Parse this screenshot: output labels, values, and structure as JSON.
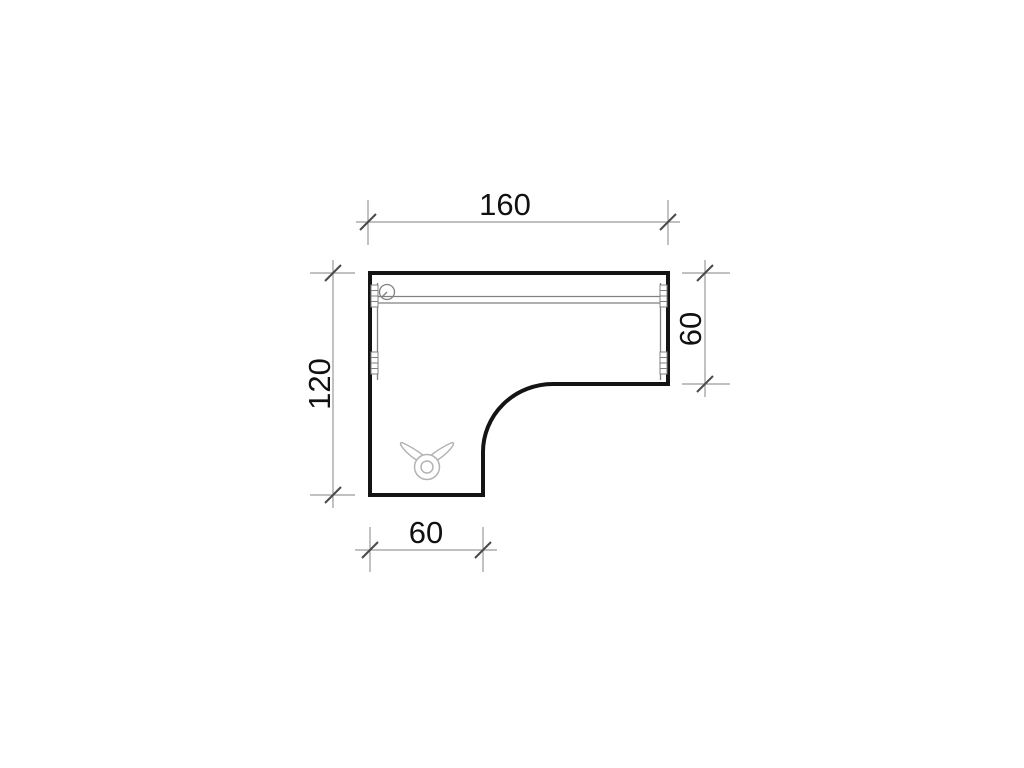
{
  "drawing": {
    "dimensions": {
      "width_top": "160",
      "depth_left": "120",
      "depth_right": "60",
      "leg_width_bottom": "60"
    },
    "icons": {
      "grommet": "cable-grommet",
      "bracket": "edge-mounting-bracket",
      "logo": "bull-head-logo"
    },
    "colors": {
      "background": "#ffffff",
      "outline": "#141414",
      "dimension_line": "#9a9a9a",
      "tick": "#4a4a4a",
      "text": "#111111",
      "detail_line": "#808080",
      "logo": "#b3b3b3"
    }
  }
}
